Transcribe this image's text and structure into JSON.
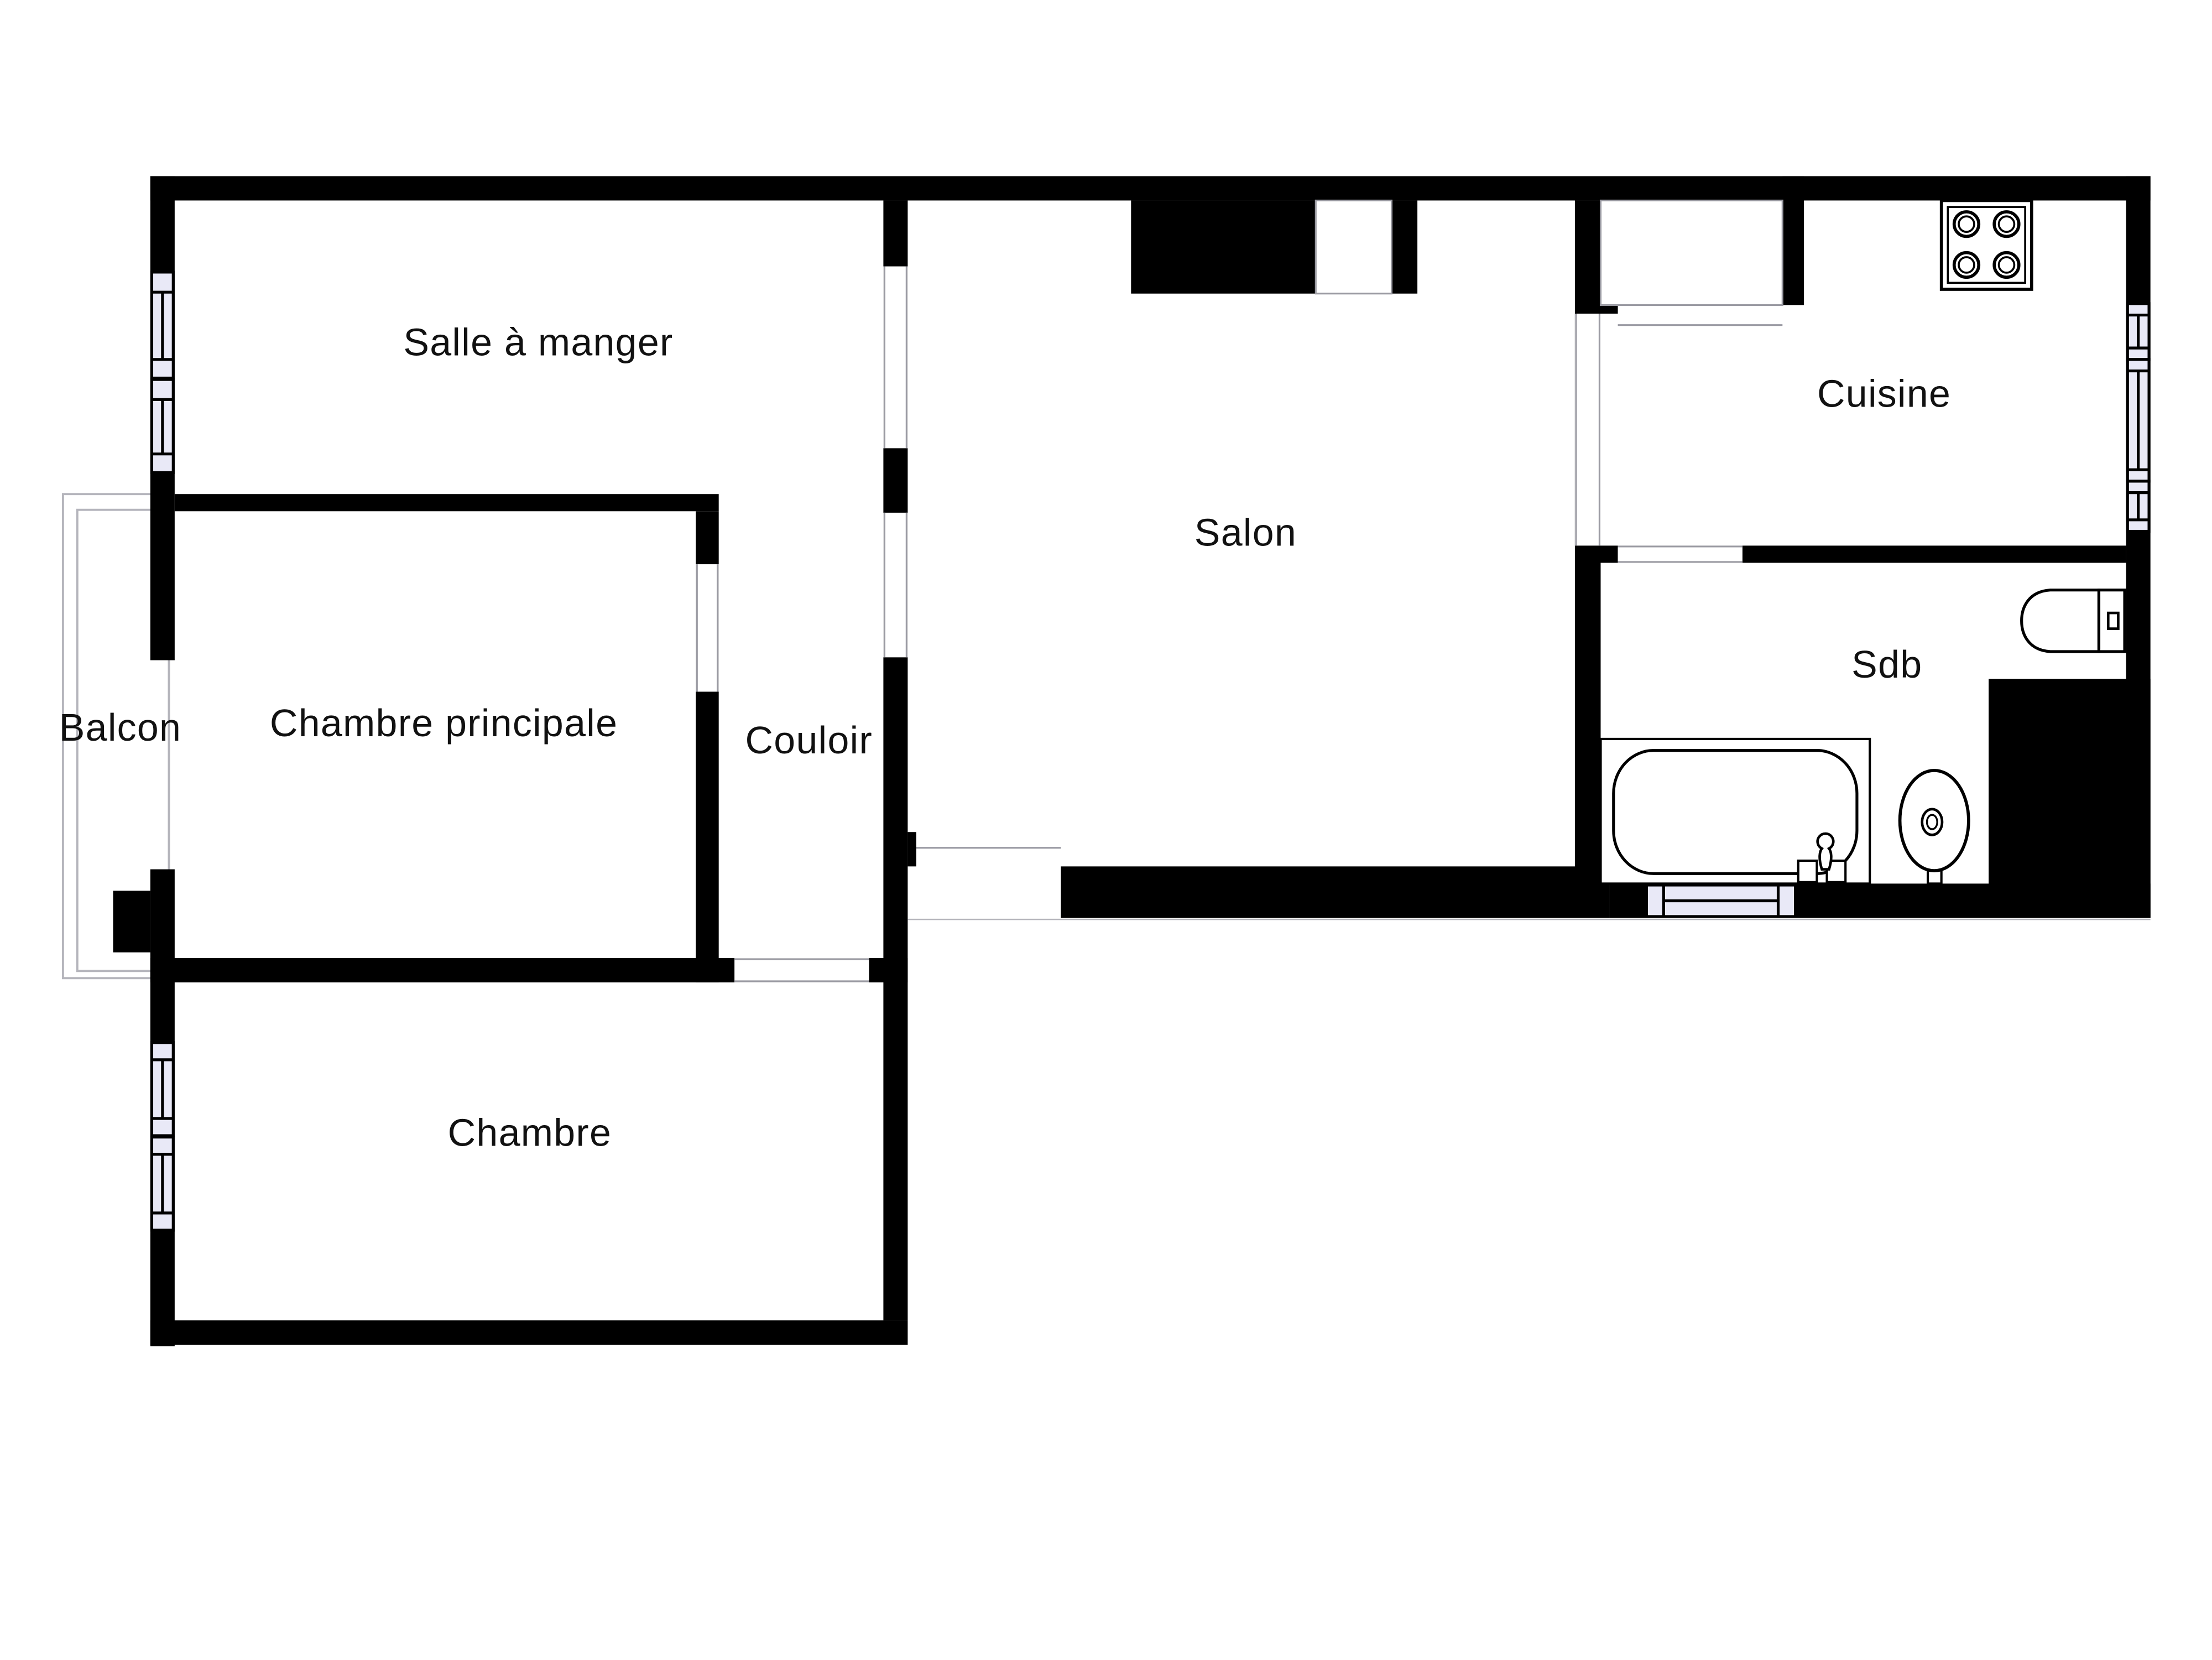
{
  "title": "Plan d'appartement",
  "colors": {
    "wall": "#000000",
    "window_fill": "#e9e9f7",
    "hairline": "#9a9aa2",
    "text": "#111111",
    "background": "#ffffff"
  },
  "rooms": [
    {
      "id": "salle-a-manger",
      "label": "Salle à manger"
    },
    {
      "id": "salon",
      "label": "Salon"
    },
    {
      "id": "cuisine",
      "label": "Cuisine"
    },
    {
      "id": "sdb",
      "label": "Sdb"
    },
    {
      "id": "balcon",
      "label": "Balcon"
    },
    {
      "id": "chambre-principale",
      "label": "Chambre principale"
    },
    {
      "id": "couloir",
      "label": "Couloir"
    },
    {
      "id": "chambre",
      "label": "Chambre"
    }
  ],
  "fixtures": [
    {
      "icon": "stove-icon",
      "room": "Cuisine",
      "burners": 4
    },
    {
      "icon": "toilet-icon",
      "room": "Sdb"
    },
    {
      "icon": "bathtub-icon",
      "room": "Sdb"
    },
    {
      "icon": "sink-icon",
      "room": "Sdb"
    }
  ],
  "windows": [
    {
      "icon": "window-icon",
      "location": "left-wall-upper"
    },
    {
      "icon": "window-icon",
      "location": "left-wall-lower"
    },
    {
      "icon": "window-icon",
      "location": "right-wall-kitchen"
    },
    {
      "icon": "window-icon",
      "location": "bathroom-bottom-wall"
    }
  ]
}
